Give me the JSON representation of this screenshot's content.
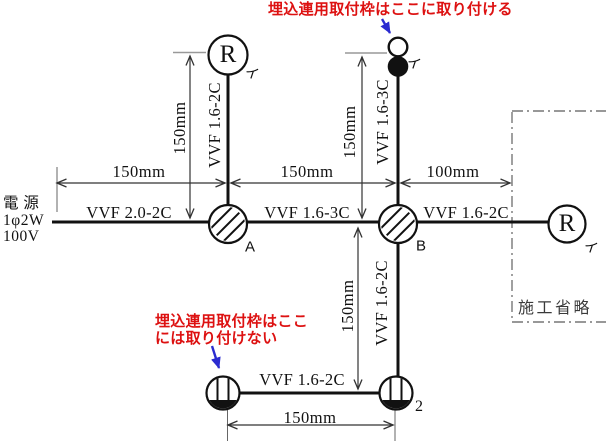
{
  "colors": {
    "note_red": "#dd1111",
    "arrow_blue": "#2b2bd0",
    "line_black": "#111111"
  },
  "notes": {
    "top": "埋込連用取付枠はここに取り付ける",
    "bottom_line1": "埋込連用取付枠はここ",
    "bottom_line2": "には取り付けない"
  },
  "power_source": {
    "name": "電 源",
    "phase": "1φ2W",
    "voltage": "100V"
  },
  "boxes": {
    "a": "A",
    "b": "B"
  },
  "devices": {
    "lamp_top": {
      "symbol": "R",
      "circuit": "イ"
    },
    "lamp_right": {
      "symbol": "R",
      "circuit": "イ"
    },
    "switch": {
      "circuit": "イ"
    },
    "outlet_right": {
      "count": "2"
    },
    "omitted_area": "施工省略"
  },
  "cables": {
    "source_to_a": "VVF 2.0-2C",
    "a_to_lamp_top": "VVF 1.6-2C",
    "a_to_b": "VVF 1.6-3C",
    "b_to_switch": "VVF 1.6-3C",
    "b_to_lamp_right": "VVF 1.6-2C",
    "b_to_outlet": "VVF 1.6-2C",
    "outlet_to_outlet": "VVF 1.6-2C"
  },
  "dims": {
    "source_to_a": "150mm",
    "a_to_b": "150mm",
    "b_to_omit": "100mm",
    "lamp_top_leg": "150mm",
    "switch_leg": "150mm",
    "outlet_leg": "150mm",
    "outlet_span": "150mm"
  }
}
